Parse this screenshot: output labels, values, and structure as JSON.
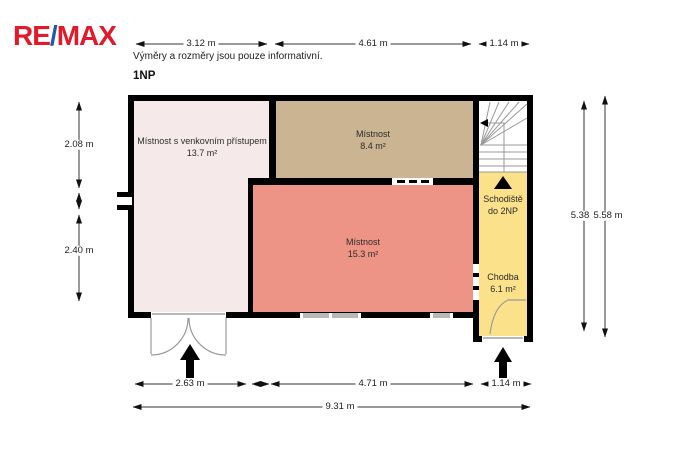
{
  "logo": {
    "part1": "RE",
    "slash": "/",
    "part2": "MAX"
  },
  "header": {
    "disclaimer": "Výměry a rozměry jsou pouze informativní.",
    "floor_label": "1NP"
  },
  "rooms": {
    "left": {
      "name": "Místnost s venkovním přístupem",
      "area": "13.7 m²"
    },
    "top": {
      "name": "Místnost",
      "area": "8.4 m²"
    },
    "main": {
      "name": "Místnost",
      "area": "15.3 m²"
    },
    "stairs": {
      "name": "Schodiště",
      "area": "do 2NP"
    },
    "hallway": {
      "name": "Chodba",
      "area": "6.1 m²"
    }
  },
  "dimensions": {
    "top": [
      "3.12 m",
      "4.61 m",
      "1.14 m"
    ],
    "bottom": [
      "2.63 m",
      "4.71 m",
      "1.14 m"
    ],
    "bottom_total": "9.31 m",
    "left": [
      "2.08 m",
      "2.40 m"
    ],
    "right": [
      "5.38",
      "5.58 m"
    ]
  },
  "colors": {
    "logo_red": "#e01a2b",
    "logo_blue": "#1f5aa8",
    "wall": "#000000",
    "room_left": "#f5eae9",
    "room_top": "#cbb491",
    "room_main": "#ee9486",
    "room_hallway": "#fae18a",
    "stairs_fill": "#ffffff",
    "window": "#b8b8b8",
    "door_line": "#9a9a9a",
    "dimension_line": "#333333"
  }
}
